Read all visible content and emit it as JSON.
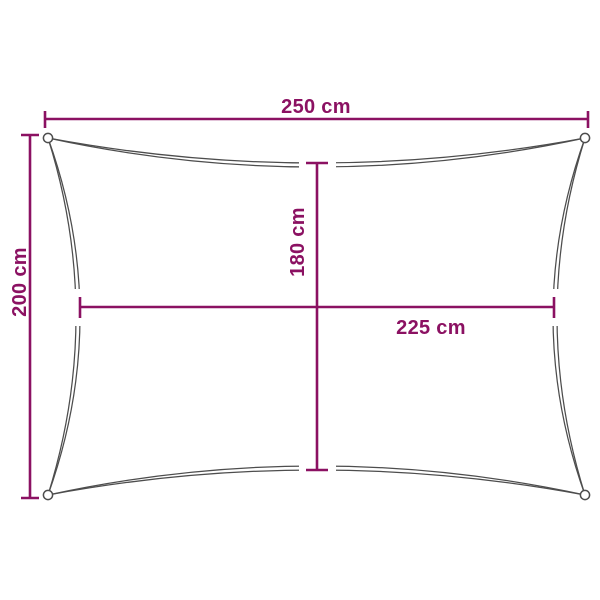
{
  "colors": {
    "accent": "#8b1162",
    "outline": "#4d4d4d",
    "background": "#ffffff"
  },
  "diagram": {
    "type": "product-dimension-diagram",
    "subject": "rectangular shade sail with concave edges and corner grommet rings",
    "measurements": {
      "outer_width": {
        "label": "250 cm",
        "value": 250,
        "unit": "cm",
        "position": "top"
      },
      "outer_height": {
        "label": "200 cm",
        "value": 200,
        "unit": "cm",
        "position": "left"
      },
      "inner_height": {
        "label": "180 cm",
        "value": 180,
        "unit": "cm",
        "position": "center-vertical"
      },
      "inner_width": {
        "label": "225 cm",
        "value": 225,
        "unit": "cm",
        "position": "center-horizontal"
      }
    }
  }
}
